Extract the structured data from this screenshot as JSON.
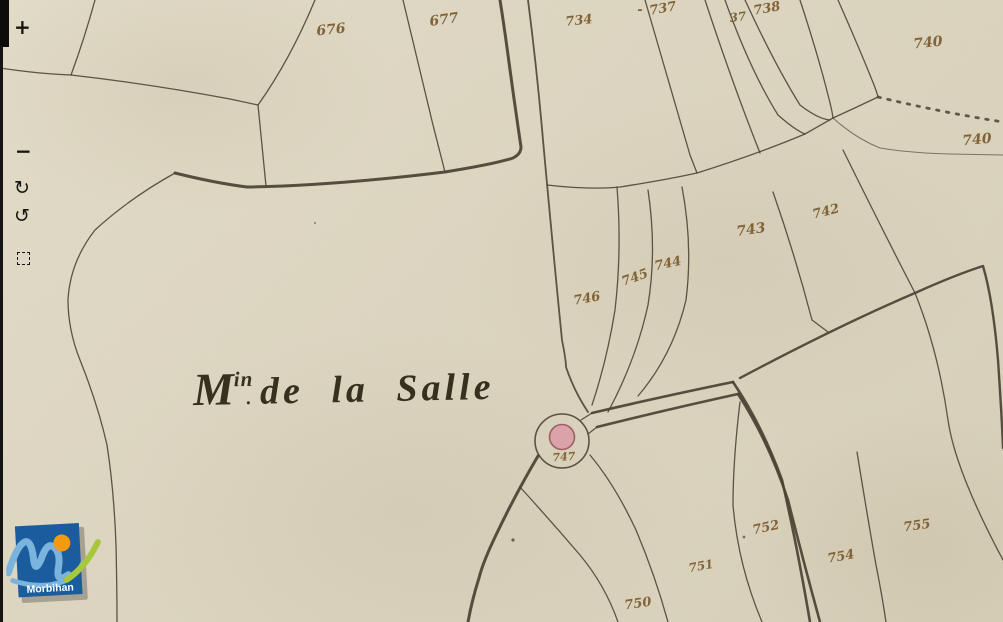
{
  "viewer": {
    "toolbar": {
      "zoom_in_label": "+",
      "zoom_out_label": "−",
      "rotate_cw_label": "↻",
      "rotate_ccw_label": "↺"
    }
  },
  "logo": {
    "label": "Morbihan"
  },
  "map": {
    "place_name": {
      "initial": "M",
      "superscript": "in",
      "separator": ".",
      "rest": "de la Salle"
    },
    "parcel_labels": [
      {
        "text": "676",
        "x": 331,
        "y": 30,
        "r": -6,
        "s": 14
      },
      {
        "text": "677",
        "x": 444,
        "y": 20,
        "r": -8,
        "s": 14
      },
      {
        "text": "734",
        "x": 579,
        "y": 21,
        "r": -6,
        "s": 13
      },
      {
        "text": "-",
        "x": 640,
        "y": 10,
        "r": 0,
        "s": 13
      },
      {
        "text": "737",
        "x": 663,
        "y": 9,
        "r": -10,
        "s": 13
      },
      {
        "text": "37",
        "x": 738,
        "y": 17,
        "r": -8,
        "s": 12
      },
      {
        "text": "738",
        "x": 767,
        "y": 9,
        "r": -10,
        "s": 13
      },
      {
        "text": "740",
        "x": 928,
        "y": 43,
        "r": -6,
        "s": 14
      },
      {
        "text": "740",
        "x": 977,
        "y": 140,
        "r": -5,
        "s": 14
      },
      {
        "text": "742",
        "x": 826,
        "y": 212,
        "r": -14,
        "s": 13
      },
      {
        "text": "743",
        "x": 751,
        "y": 230,
        "r": -8,
        "s": 14
      },
      {
        "text": "744",
        "x": 668,
        "y": 264,
        "r": -12,
        "s": 13
      },
      {
        "text": "745",
        "x": 635,
        "y": 278,
        "r": -20,
        "s": 13
      },
      {
        "text": "746",
        "x": 587,
        "y": 299,
        "r": -10,
        "s": 13
      },
      {
        "text": "747",
        "x": 564,
        "y": 457,
        "r": -4,
        "s": 11
      },
      {
        "text": "750",
        "x": 638,
        "y": 604,
        "r": -8,
        "s": 13
      },
      {
        "text": "751",
        "x": 701,
        "y": 566,
        "r": -10,
        "s": 12
      },
      {
        "text": "752",
        "x": 766,
        "y": 528,
        "r": -12,
        "s": 13
      },
      {
        "text": "754",
        "x": 841,
        "y": 557,
        "r": -10,
        "s": 13
      },
      {
        "text": "755",
        "x": 917,
        "y": 526,
        "r": -8,
        "s": 13
      }
    ]
  },
  "colors": {
    "paper": "#ddd6c1",
    "ink_line": "#473e31",
    "ink_number": "#7b5a2d",
    "mill_fill": "#dca2ab",
    "mill_stroke": "#9c5f63",
    "logo_blue": "#1b5c9e",
    "logo_orange": "#f49a10",
    "logo_lightblue": "#7ab4dc",
    "logo_green": "#a8c83c"
  }
}
